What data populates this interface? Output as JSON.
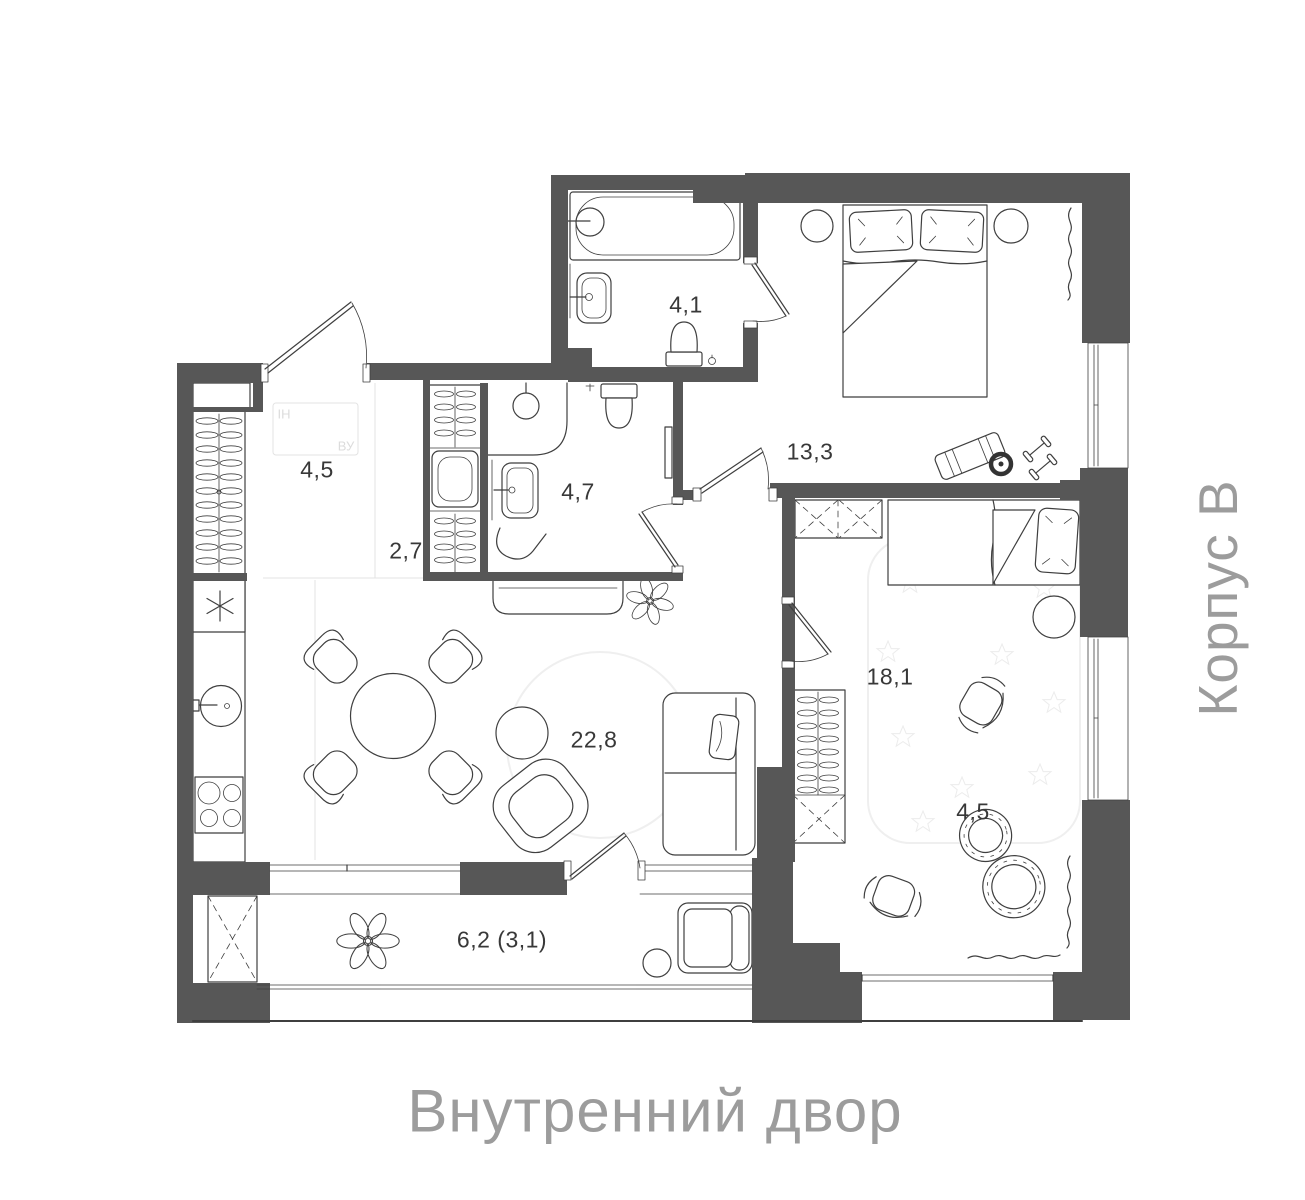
{
  "title_labels": {
    "building": "Корпус В",
    "courtyard": "Внутренний двор"
  },
  "rooms": [
    {
      "name": "hallway",
      "area_label": "4,5"
    },
    {
      "name": "wardrobe-closet",
      "area_label": "2,7"
    },
    {
      "name": "bathroom",
      "area_label": "4,7"
    },
    {
      "name": "ensuite-bathroom",
      "area_label": "4,1"
    },
    {
      "name": "bedroom",
      "area_label": "13,3"
    },
    {
      "name": "kitchen-living-room",
      "area_label": "22,8"
    },
    {
      "name": "kids-room",
      "area_label": "18,1"
    },
    {
      "name": "play-area",
      "area_label": "4,5"
    },
    {
      "name": "balcony",
      "area_label": "6,2 (3,1)"
    }
  ],
  "utility_marks": {
    "left": "ІН",
    "right": "ВУ"
  },
  "colors": {
    "wall": "#575757",
    "line": "#3f3f3f",
    "room_label": "#383838",
    "muted_text": "#9c9c9c",
    "faint_line": "#e3e3e3"
  }
}
